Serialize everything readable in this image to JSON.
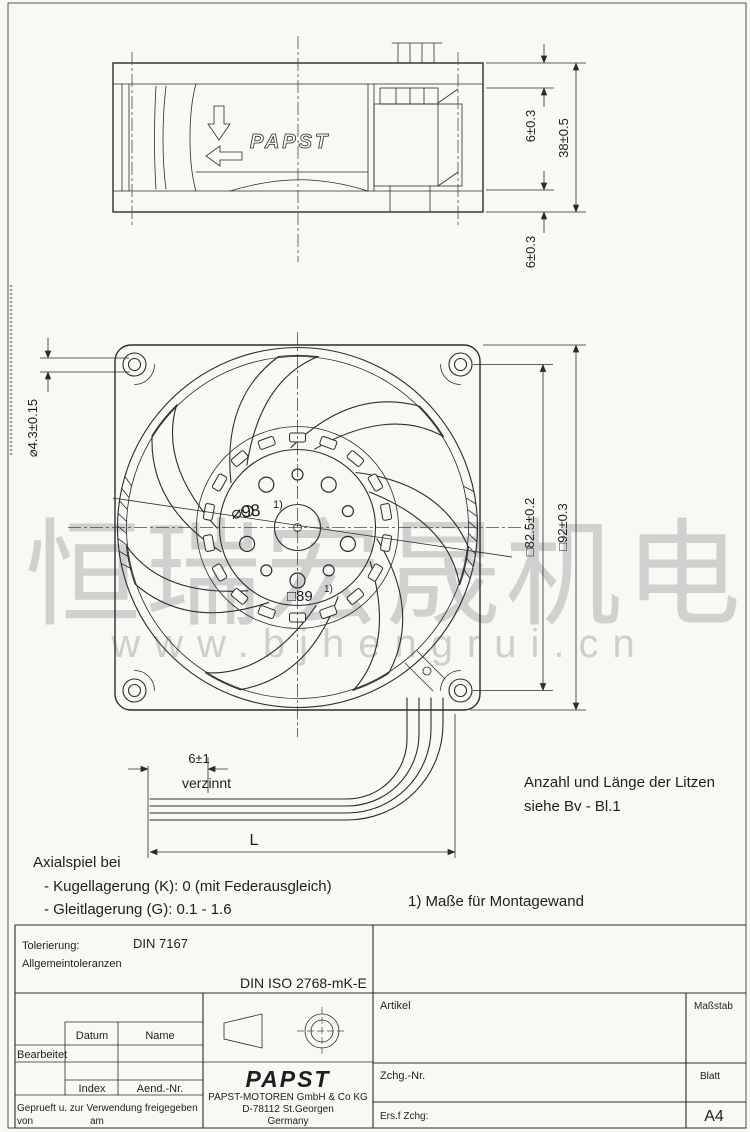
{
  "watermark": {
    "cn": "恒瑞宏晟机电",
    "url": "www.bjhengrui.cn"
  },
  "side_view": {
    "brand": "PAPST",
    "dims": {
      "flange_top": "6±0.3",
      "depth": "38±0.5",
      "flange_bottom": "6±0.3"
    }
  },
  "front_view": {
    "dims": {
      "mounting_hole": "⌀4.3±0.15",
      "impeller": "⌀98",
      "hub_square": "□89",
      "hole_pitch": "□82.5±0.2",
      "frame": "□92±0.3",
      "ref_mark": "1)"
    }
  },
  "wire_detail": {
    "tinned_len": "6±1",
    "tinned_label": "verzinnt",
    "length": "L"
  },
  "notes": {
    "litzen_1": "Anzahl und Länge der Litzen",
    "litzen_2": "siehe Bv - Bl.1",
    "montage": "1) Maße für Montagewand",
    "axial_title": "Axialspiel bei",
    "axial_1": "- Kugellagerung (K): 0 (mit Federausgleich)",
    "axial_2": "- Gleitlagerung (G): 0.1 - 1.6"
  },
  "title_block": {
    "tolerierung_label": "Tolerierung:",
    "tolerierung_value": "DIN 7167",
    "allgemein": "Allgemeintoleranzen",
    "din_iso": "DIN ISO 2768-mK-E",
    "datum": "Datum",
    "name": "Name",
    "bearbeitet": "Bearbeitet",
    "index": "Index",
    "aend_nr": "Aend.-Nr.",
    "geprueft": "Geprueft u. zur Verwendung freigegeben",
    "von": "von",
    "am": "am",
    "logo": "PAPST",
    "company": "PAPST-MOTOREN GmbH & Co KG",
    "address": "D-78112 St.Georgen",
    "country": "Germany",
    "artikel": "Artikel",
    "massstab": "Maßstab",
    "zchg_nr": "Zchg.-Nr.",
    "blatt": "Blatt",
    "ers_zchg": "Ers.f Zchg:",
    "format": "A4"
  }
}
